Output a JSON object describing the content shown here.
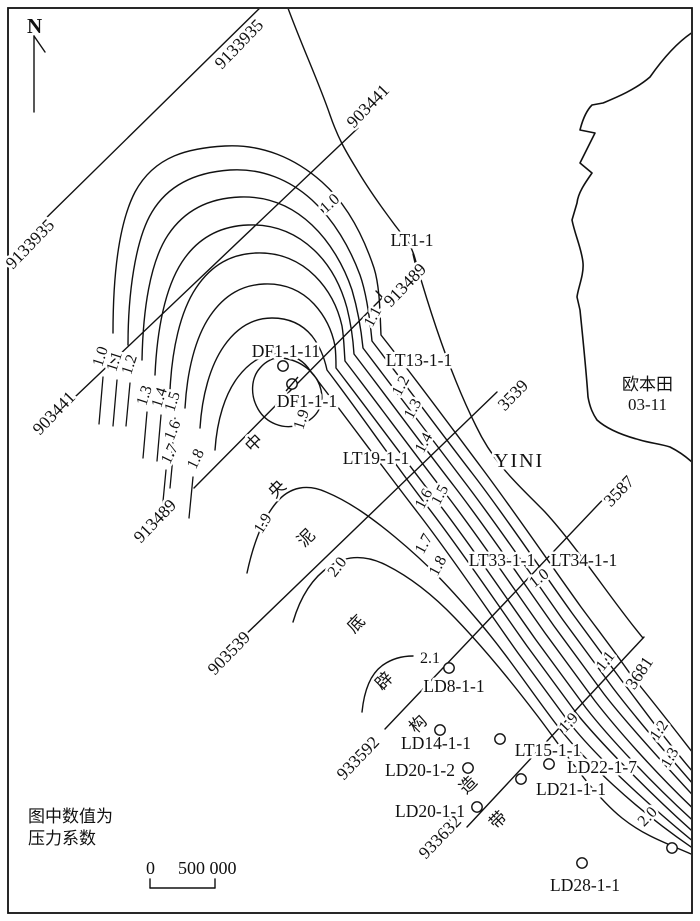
{
  "map": {
    "north_label": "N",
    "note_line1": "图中数值为",
    "note_line2": "压力系数",
    "scale_zero": "0",
    "scale_value": "500 000",
    "area_name": "欧本田",
    "area_code": "03-11",
    "region_name": "YINI",
    "belt_name": "中央泥底辟构造带",
    "belt_chars": [
      {
        "t": "中",
        "x": 258,
        "y": 447,
        "r": -45
      },
      {
        "t": "央",
        "x": 281,
        "y": 493,
        "r": -45
      },
      {
        "t": "泥",
        "x": 310,
        "y": 542,
        "r": -45
      },
      {
        "t": "底",
        "x": 360,
        "y": 628,
        "r": -45
      },
      {
        "t": "辟",
        "x": 388,
        "y": 685,
        "r": -45
      },
      {
        "t": "构",
        "x": 422,
        "y": 728,
        "r": -45
      },
      {
        "t": "造",
        "x": 472,
        "y": 789,
        "r": -45
      },
      {
        "t": "带",
        "x": 502,
        "y": 824,
        "r": -45
      }
    ],
    "section_labels": [
      {
        "t": "9133935",
        "x": 243,
        "y": 48,
        "r": -46
      },
      {
        "t": "9133935",
        "x": 34,
        "y": 248,
        "r": -46
      },
      {
        "t": "903441",
        "x": 372,
        "y": 110,
        "r": -46
      },
      {
        "t": "903441",
        "x": 58,
        "y": 417,
        "r": -46
      },
      {
        "t": "913489",
        "x": 409,
        "y": 289,
        "r": -46
      },
      {
        "t": "913489",
        "x": 159,
        "y": 525,
        "r": -46
      },
      {
        "t": "3539",
        "x": 517,
        "y": 399,
        "r": -46
      },
      {
        "t": "903539",
        "x": 233,
        "y": 657,
        "r": -46
      },
      {
        "t": "3587",
        "x": 623,
        "y": 495,
        "r": -46
      },
      {
        "t": "933592",
        "x": 362,
        "y": 762,
        "r": -46
      },
      {
        "t": "3681",
        "x": 644,
        "y": 676,
        "r": -56
      },
      {
        "t": "933632",
        "x": 444,
        "y": 841,
        "r": -46
      }
    ],
    "contour_labels": [
      {
        "t": "1.0",
        "x": 105,
        "y": 358,
        "r": -72
      },
      {
        "t": "1.1",
        "x": 119,
        "y": 363,
        "r": -72
      },
      {
        "t": "1.2",
        "x": 134,
        "y": 366,
        "r": -72
      },
      {
        "t": "1.3",
        "x": 149,
        "y": 397,
        "r": -72
      },
      {
        "t": "1.4",
        "x": 164,
        "y": 399,
        "r": -72
      },
      {
        "t": "1.5",
        "x": 177,
        "y": 403,
        "r": -72
      },
      {
        "t": "1.6",
        "x": 177,
        "y": 432,
        "r": -68
      },
      {
        "t": "1.7",
        "x": 174,
        "y": 456,
        "r": -64
      },
      {
        "t": "1.8",
        "x": 200,
        "y": 461,
        "r": -64
      },
      {
        "t": "1.0",
        "x": 333,
        "y": 207,
        "r": -42
      },
      {
        "t": "1.1",
        "x": 377,
        "y": 319,
        "r": -62
      },
      {
        "t": "1.2",
        "x": 405,
        "y": 388,
        "r": -62
      },
      {
        "t": "1.3",
        "x": 417,
        "y": 411,
        "r": -62
      },
      {
        "t": "1.4",
        "x": 428,
        "y": 445,
        "r": -62
      },
      {
        "t": "1.5",
        "x": 444,
        "y": 497,
        "r": -62
      },
      {
        "t": "1.6",
        "x": 428,
        "y": 501,
        "r": -62
      },
      {
        "t": "1.7",
        "x": 428,
        "y": 546,
        "r": -62
      },
      {
        "t": "1.8",
        "x": 442,
        "y": 568,
        "r": -62
      },
      {
        "t": "1.9",
        "x": 306,
        "y": 421,
        "r": -72
      },
      {
        "t": "1.9",
        "x": 267,
        "y": 526,
        "r": -58
      },
      {
        "t": "2.0",
        "x": 341,
        "y": 570,
        "r": -52
      },
      {
        "t": "2.1",
        "x": 430,
        "y": 663,
        "r": 0
      },
      {
        "t": "1.0",
        "x": 542,
        "y": 582,
        "r": -38
      },
      {
        "t": "1.1",
        "x": 609,
        "y": 664,
        "r": -52
      },
      {
        "t": "1.9",
        "x": 572,
        "y": 726,
        "r": -46
      },
      {
        "t": "1.2",
        "x": 663,
        "y": 733,
        "r": -56
      },
      {
        "t": "1.3",
        "x": 674,
        "y": 760,
        "r": -60
      },
      {
        "t": "2.0",
        "x": 651,
        "y": 820,
        "r": -46
      }
    ],
    "wells": [
      {
        "name": "LT1-1",
        "x": 412,
        "y": 246
      },
      {
        "name": "DF1-1-11",
        "x": 286,
        "y": 357
      },
      {
        "name": "DF1-1-1",
        "x": 307,
        "y": 407
      },
      {
        "name": "LT13-1-1",
        "x": 419,
        "y": 366
      },
      {
        "name": "LT19-1-1",
        "x": 376,
        "y": 464
      },
      {
        "name": "LT33-1-1",
        "x": 502,
        "y": 566
      },
      {
        "name": "LT34-1-1",
        "x": 584,
        "y": 566
      },
      {
        "name": "LD8-1-1",
        "x": 454,
        "y": 692
      },
      {
        "name": "LD14-1-1",
        "x": 436,
        "y": 749
      },
      {
        "name": "LT15-1-1",
        "x": 548,
        "y": 756
      },
      {
        "name": "LD20-1-2",
        "x": 420,
        "y": 776
      },
      {
        "name": "LD22-1-7",
        "x": 602,
        "y": 773
      },
      {
        "name": "LD21-1-1",
        "x": 571,
        "y": 795
      },
      {
        "name": "LD20-1-1",
        "x": 430,
        "y": 817
      },
      {
        "name": "LD28-1-1",
        "x": 585,
        "y": 891
      }
    ],
    "well_symbols": [
      {
        "type": "circle",
        "x": 283,
        "y": 366
      },
      {
        "type": "slashed-circle",
        "x": 292,
        "y": 384
      },
      {
        "type": "circle",
        "x": 449,
        "y": 668
      },
      {
        "type": "circle",
        "x": 440,
        "y": 730
      },
      {
        "type": "circle",
        "x": 500,
        "y": 739
      },
      {
        "type": "circle",
        "x": 468,
        "y": 768
      },
      {
        "type": "circle",
        "x": 549,
        "y": 764
      },
      {
        "type": "circle",
        "x": 521,
        "y": 779
      },
      {
        "type": "circle",
        "x": 477,
        "y": 807
      },
      {
        "type": "circle",
        "x": 582,
        "y": 863
      },
      {
        "type": "circle",
        "x": 672,
        "y": 848
      }
    ]
  }
}
